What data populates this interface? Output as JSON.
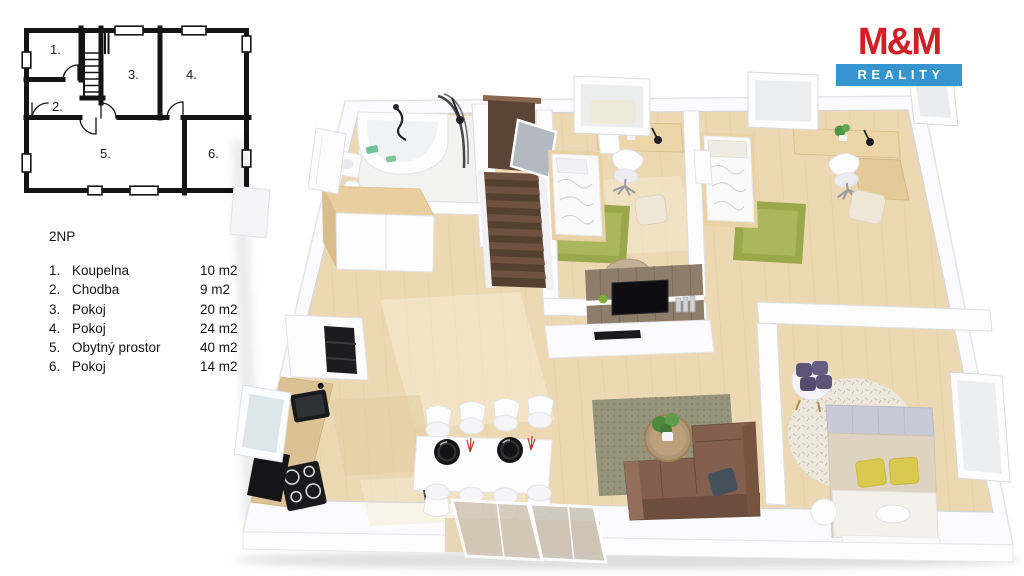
{
  "page": {
    "background": "#ffffff"
  },
  "logo": {
    "top": "M&M",
    "bottom": "REALITY",
    "colors": {
      "red": "#ce2127",
      "blue": "#3695ce",
      "text": "#ffffff"
    }
  },
  "legend": {
    "title": "2NP",
    "items": [
      {
        "num": "1.",
        "label": "Koupelna",
        "area": "10 m2"
      },
      {
        "num": "2.",
        "label": "Chodba",
        "area": "9 m2"
      },
      {
        "num": "3.",
        "label": "Pokoj",
        "area": "20 m2"
      },
      {
        "num": "4.",
        "label": "Pokoj",
        "area": "24 m2"
      },
      {
        "num": "5.",
        "label": "Obytný prostor",
        "area": "40 m2"
      },
      {
        "num": "6.",
        "label": "Pokoj",
        "area": "14 m2"
      }
    ]
  },
  "plan2d": {
    "room_numbers": [
      "1.",
      "2.",
      "3.",
      "4.",
      "5.",
      "6."
    ]
  },
  "plan3d": {
    "colors": {
      "floor_wood": "#ecd9b4",
      "bathroom_floor": "#f2f2f0",
      "walls": "#fbfbfd",
      "stairs_brown": "#5b4435",
      "rug_green": "#9aa84c",
      "living_rug": "#96947b",
      "sofa_brown": "#83604e",
      "kitchen_counter": "#dcc194",
      "bed_linen": "#fafafa",
      "bed6_headboard": "#c9c9d7",
      "bed6_blanket": "#ddd3c0",
      "pillow_yellow": "#d9c94f",
      "armchair_purple": "#5c5477",
      "appliance_black": "#1c1c1e"
    }
  }
}
